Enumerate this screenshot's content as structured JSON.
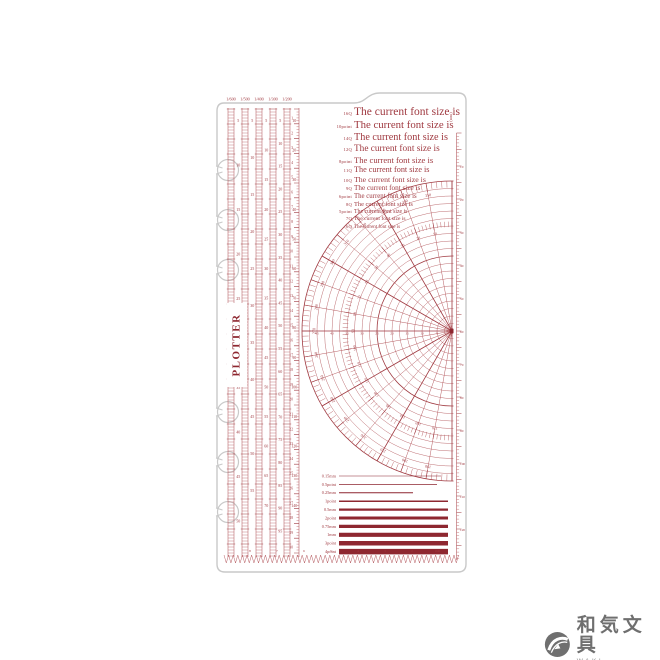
{
  "product": {
    "brand": "PLOTTER"
  },
  "colors": {
    "ink": "#a03a41",
    "ink_dark": "#8e2730",
    "ink_light": "#b65c61",
    "outline": "#c9c9c9",
    "logo_gray": "#6f6f6f"
  },
  "scales": [
    {
      "header": "1/600",
      "labels_start": 5,
      "labels_step": 5,
      "labels_count": 10
    },
    {
      "header": "1/500",
      "labels_start": 5,
      "labels_step": 5,
      "labels_count": 11
    },
    {
      "header": "1/400",
      "labels_start": 5,
      "labels_step": 5,
      "labels_count": 14
    },
    {
      "header": "1/300",
      "labels_start": 5,
      "labels_step": 5,
      "labels_count": 19
    },
    {
      "header": "1/200",
      "labels_start": 10,
      "labels_step": 10,
      "labels_count": 14
    }
  ],
  "cm_scale": {
    "labels_start": 1,
    "labels_step": 1,
    "labels_count": 30
  },
  "font_samples": {
    "sample_text": "The current font size is",
    "lines": [
      {
        "label": "16Q",
        "size": 11.5
      },
      {
        "label": "10point",
        "size": 10.8
      },
      {
        "label": "14Q",
        "size": 10.2
      },
      {
        "label": "12Q",
        "size": 9.3
      },
      {
        "label": "8point",
        "size": 8.6
      },
      {
        "label": "11Q",
        "size": 8.2
      },
      {
        "label": "10Q",
        "size": 7.8
      },
      {
        "label": "9Q",
        "size": 7.2
      },
      {
        "label": "6point",
        "size": 6.8
      },
      {
        "label": "8Q",
        "size": 6.4
      },
      {
        "label": "5point",
        "size": 5.8
      },
      {
        "label": "7Q",
        "size": 5.6
      },
      {
        "label": "6Q",
        "size": 5.0
      }
    ]
  },
  "chart_data": {
    "type": "protractor-radial-grid",
    "outer_degree_labels": [
      350,
      340,
      330,
      320,
      310,
      300,
      290,
      280,
      270,
      260,
      250,
      240,
      230,
      220,
      210,
      200,
      190
    ],
    "inner_degree_labels": [
      10,
      20,
      30,
      40,
      50,
      60,
      70,
      80,
      90,
      100,
      110,
      120,
      130,
      140,
      150,
      160,
      170
    ],
    "axis_mm_labels": [
      5,
      10,
      15,
      20,
      25,
      30,
      35,
      40,
      45
    ],
    "radial_line_step_deg": 10,
    "fine_tick_step_deg": 2,
    "concentric_circle_count": 20
  },
  "line_samples": [
    {
      "label": "0.15mm",
      "weight": 0.6,
      "end": 441
    },
    {
      "label": "0.5point",
      "weight": 0.8,
      "end": 437
    },
    {
      "label": "0.25mm",
      "weight": 1.0,
      "end": 413
    },
    {
      "label": "1point",
      "weight": 1.5,
      "end": 448
    },
    {
      "label": "0.5mm",
      "weight": 2.2,
      "end": 448
    },
    {
      "label": "2point",
      "weight": 3.0,
      "end": 448
    },
    {
      "label": "0.75mm",
      "weight": 3.2,
      "end": 448
    },
    {
      "label": "1mm",
      "weight": 4.1,
      "end": 448
    },
    {
      "label": "3point",
      "weight": 4.5,
      "end": 448
    },
    {
      "label": "4point",
      "weight": 5.5,
      "end": 448
    }
  ],
  "right_ruler": {
    "unit": "(mm)",
    "labels": [
      10,
      20,
      30,
      40,
      50,
      60,
      70,
      80,
      90,
      100,
      110,
      120
    ]
  },
  "bottom_ruler": {
    "labels": [
      "8",
      "7",
      "6",
      "5",
      "4",
      "3",
      "2",
      "1",
      "160"
    ]
  },
  "logo": {
    "jp": "和気文具",
    "en": "WAKI STATIONERY"
  }
}
